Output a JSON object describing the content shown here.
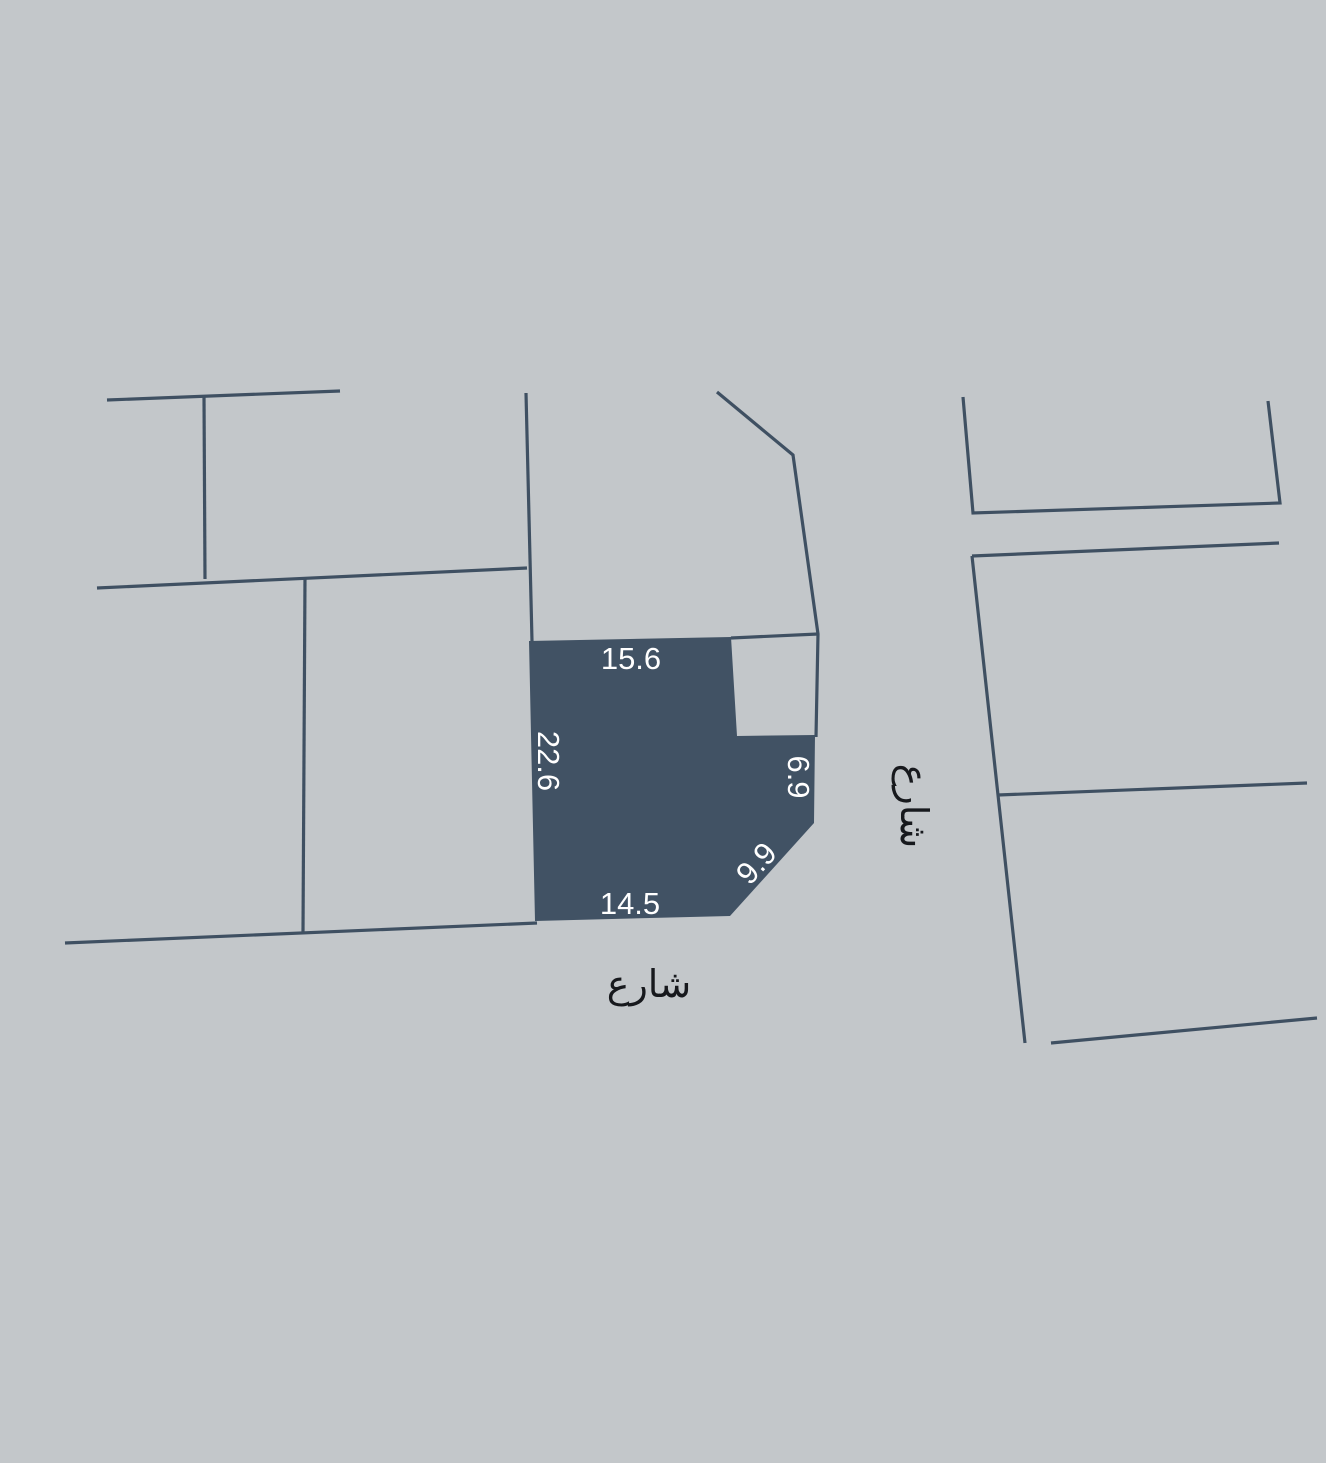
{
  "map": {
    "colors": {
      "background": "#c3c7ca",
      "boundary_line": "#3f5062",
      "parcel_fill": "#415264",
      "dimension_text": "#ffffff",
      "street_text": "#17191d"
    },
    "parcel": {
      "dimensions": {
        "top": "15.6",
        "left": "22.6",
        "right": "6.9",
        "corner": "9.9",
        "bottom": "14.5"
      }
    },
    "streets": {
      "south": "شارع",
      "east": "شارع"
    }
  }
}
